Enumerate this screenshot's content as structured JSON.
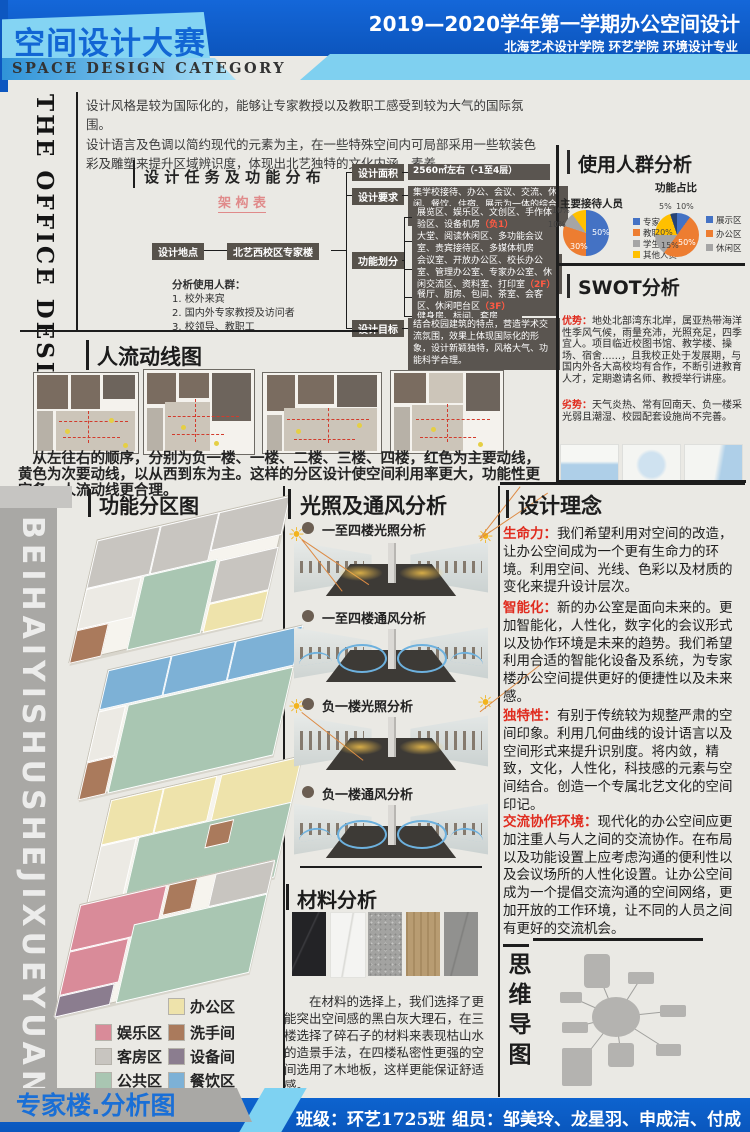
{
  "header": {
    "title": "空间设计大赛",
    "subtitle": "SPACE DESIGN CATEGORY",
    "term": "2019—2020学年第一学期办公空间设计",
    "school": "北海艺术设计学院  环艺学院  环境设计专业"
  },
  "side_label": "THE OFFICE DESIGN",
  "watermark": "BEIHAIYISHUSHEJIXUEYUAN",
  "intro": {
    "p1": "设计风格是较为国际化的，能够让专家教授以及教职工感受到较为大气的国际氛围。",
    "p2": "设计语言及色调以简约现代的元素为主，在一些特殊空间内可局部采用一些软装色彩及雕塑来提升区域辨识度，体现出北艺独特的文化内涵、素养。"
  },
  "tasks": {
    "title": "设 计 任 务 及 功 能 分 布",
    "subtitle": "架 构 表",
    "location_label": "设计地点",
    "location_value": "北艺西校区专家楼",
    "area_label": "设计面积",
    "area_value": "2560㎡左右（-1至4层）",
    "require_label": "设计要求",
    "require_value": "集学校接待、办公、会议、交流、休闲、餐饮、住宿、展示为一体的综合性办公楼",
    "division_label": "功能划分",
    "divisions": [
      {
        "text": "展览区、娱乐区、文创区、手作体验区、设备机房",
        "floor": "（负1）"
      },
      {
        "text": "大堂、阅读休闲区、多功能会议室、贵宾接待区、多媒体机房",
        "floor": "（1F）"
      },
      {
        "text": "会议室、开放办公区、校长办公室、管理办公室、专家办公室、休闲交流区、资料室、打印室",
        "floor": "（2F）"
      },
      {
        "text": "餐厅、厨房、包间、茶室、会客区、休闲吧台区",
        "floor": "（3F）"
      },
      {
        "text": "健身房、标间、套房",
        "floor": "（4F）"
      }
    ],
    "goal_label": "设计目标",
    "goal_value": "结合校园建筑的特点，营造学术交流氛围，效果上体现国际化的形象，设计新颖独特，风格大气、功能科学合理。",
    "users_title": "分析使用人群：",
    "users": [
      "1.  校外来宾",
      "2.  国内外专家教授及访问者",
      "3.  校领导、教职工"
    ]
  },
  "users_panel": {
    "title": "使用人群分析",
    "pie1": {
      "title": "主要接待人员",
      "slices": [
        {
          "label": "专家",
          "value": 50,
          "color": "#4472c4"
        },
        {
          "label": "教职工",
          "value": 30,
          "color": "#ed7d31"
        },
        {
          "label": "学生",
          "value": 10,
          "color": "#a5a5a5"
        },
        {
          "label": "其他人员",
          "value": 10,
          "color": "#ffc000"
        }
      ],
      "value_labels": [
        "50%",
        "30%",
        "10%",
        "10%"
      ]
    },
    "pie2": {
      "title": "功能占比",
      "slices": [
        {
          "label": "展示区",
          "value": 10,
          "color": "#4472c4"
        },
        {
          "label": "办公区",
          "value": 50,
          "color": "#ed7d31"
        },
        {
          "label": "休闲区",
          "value": 15,
          "color": "#a5a5a5"
        },
        {
          "label": "",
          "value": 20,
          "color": "#ffc000"
        },
        {
          "label": "",
          "value": 5,
          "color": "#264478"
        }
      ],
      "legend": [
        "展示区",
        "办公区",
        "休闲区"
      ],
      "value_labels": [
        "10%",
        "50%",
        "15%",
        "20%",
        "5%"
      ]
    }
  },
  "swot": {
    "title": "SWOT分析",
    "s_label": "优势：",
    "s_text": "地处北部湾东北岸，属亚热带海洋性季风气候，雨量充沛，光照充足，四季宜人。项目临近校图书馆、教学楼、操场、宿舍......，且我校正处于发展期，与国内外各大高校均有合作，不断引进教育人才，定期邀请名师、教授举行讲座。",
    "w_label": "劣势：",
    "w_text": "天气炎热、常有回南天、负一楼采光弱且潮湿、校园配套设施尚不完善。"
  },
  "flow": {
    "title": "人流动线图",
    "caption": "　从左往右的顺序，分别为负一楼、一楼、二楼、三楼、四楼，红色为主要动线，黄色为次要动线，以从西到东为主。这样的分区设计使空间利用率更大，功能性更完备，人流动线更合理。"
  },
  "zoning": {
    "title": "功能分区图",
    "legend": [
      {
        "label": "办公区",
        "color": "#eee3ab"
      },
      {
        "label": "娱乐区",
        "color": "#d98b99"
      },
      {
        "label": "洗手间",
        "color": "#aa7a5c"
      },
      {
        "label": "客房区",
        "color": "#c8c5c0"
      },
      {
        "label": "设备间",
        "color": "#8b7d8f"
      },
      {
        "label": "公共区",
        "color": "#a9c6b2"
      },
      {
        "label": "餐饮区",
        "color": "#7db1d6"
      }
    ],
    "caption": "专家楼.分析图"
  },
  "light": {
    "title": "光照及通风分析",
    "items": [
      "一至四楼光照分析",
      "一至四楼通风分析",
      "负一楼光照分析",
      "负一楼通风分析"
    ]
  },
  "materials": {
    "title": "材料分析",
    "text": "　　在材料的选择上，我们选择了更能突出空间感的黑白灰大理石，在三楼选择了碎石子的材料来表现枯山水的造景手法，在四楼私密性更强的空间选用了木地板，这样更能保证舒适感。"
  },
  "concept": {
    "title": "设计理念",
    "items": [
      {
        "label": "生命力：",
        "text": "我们希望利用对空间的改造，让办公空间成为一个更有生命力的环境。利用空间、光线、色彩以及材质的变化来提升设计层次。"
      },
      {
        "label": "智能化：",
        "text": "新的办公室是面向未来的。更加智能化，人性化，数字化的会议形式以及协作环境是未来的趋势。我们希望利用合适的智能化设备及系统，为专家楼办公空间提供更好的便捷性以及未来感。"
      },
      {
        "label": "独特性：",
        "text": "有别于传统较为规整严肃的空间印象。利用几何曲线的设计语言以及空间形式来提升识别度。将内敛，精致，文化，人性化，科技感的元素与空间结合。创造一个专属北艺文化的空间印记。"
      },
      {
        "label": "交流协作环境：",
        "text": "现代化的办公空间应更加注重人与人之间的交流协作。在布局以及功能设置上应考虑沟通的便利性以及会议场所的人性化设置。让办公空间成为一个提倡交流沟通的空间网络，更加开放的工作环境，让不同的人员之间有更好的交流机会。"
      }
    ]
  },
  "mindmap": {
    "title": "思维导图"
  },
  "footer": {
    "class": "班级：环艺1725班",
    "members": "组员：邹美玲、龙星羽、申成洁、付成军"
  },
  "colors": {
    "accent_blue": "#0d5ec9",
    "light_blue": "#7ed2f2",
    "red": "#e02b1e"
  }
}
